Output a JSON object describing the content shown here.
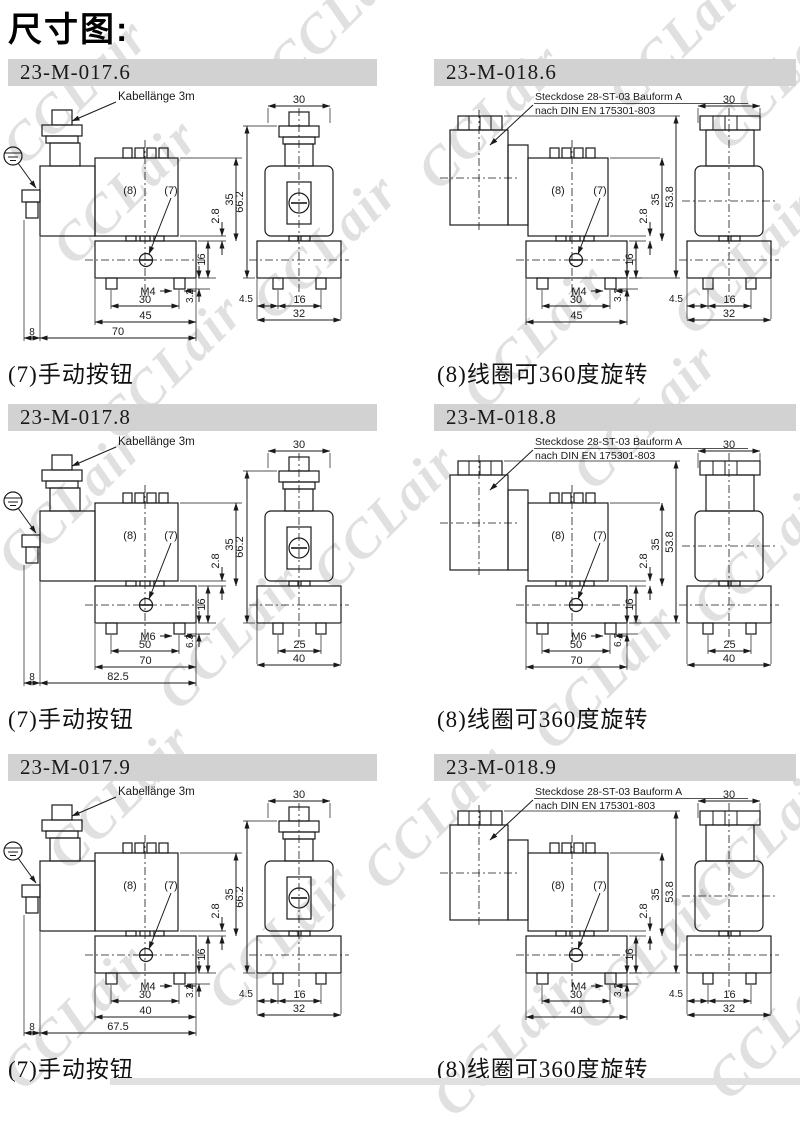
{
  "page": {
    "title": "尺寸图:",
    "watermark_text": "CCLair"
  },
  "colors": {
    "titlebar_bg": "#d2d2d2",
    "line": "#1a1a1a",
    "watermark": "rgba(0,0,0,0.12)"
  },
  "panels": [
    {
      "id": "23-M-017.6",
      "type": "cable",
      "top_label": "Kabellänge 3m",
      "top_label2": "",
      "callout_coil": "(8)",
      "callout_button": "(7)",
      "caption": "(7)手动按钮",
      "dims": {
        "coil_h": "35",
        "gap": "2.8",
        "body_h": "16",
        "thread_depth": "3.2",
        "thread": "M4",
        "hole_spacing": "30",
        "body_w": "45",
        "overall_w": "70",
        "left_offset": "8",
        "overall_h": "66.2",
        "front_w": "30",
        "front_foot_off": "4.5",
        "front_holes": "16",
        "front_w2": "32"
      }
    },
    {
      "id": "23-M-018.6",
      "type": "connector",
      "top_label": "Steckdose 28-ST-03 Bauform A",
      "top_label2": "nach DIN EN 175301-803",
      "callout_coil": "(8)",
      "callout_button": "(7)",
      "caption": "(8)线圈可360度旋转",
      "dims": {
        "coil_h": "35",
        "gap": "2.8",
        "body_h": "16",
        "thread_depth": "3.2",
        "thread": "M4",
        "hole_spacing": "30",
        "body_w": "45",
        "overall_h": "53.8",
        "front_w": "30",
        "front_foot_off": "4.5",
        "front_holes": "16",
        "front_w2": "32"
      }
    },
    {
      "id": "23-M-017.8",
      "type": "cable",
      "top_label": "Kabellänge 3m",
      "top_label2": "",
      "callout_coil": "(8)",
      "callout_button": "(7)",
      "caption": "(7)手动按钮",
      "dims": {
        "coil_h": "35",
        "gap": "2.8",
        "body_h": "16",
        "thread_depth": "6.3",
        "thread": "M6",
        "hole_spacing": "50",
        "body_w": "70",
        "overall_w": "82.5",
        "left_offset": "8",
        "overall_h": "66.2",
        "front_w": "30",
        "front_foot_off": null,
        "front_holes": "25",
        "front_w2": "40"
      }
    },
    {
      "id": "23-M-018.8",
      "type": "connector",
      "top_label": "Steckdose 28-ST-03 Bauform A",
      "top_label2": "nach DIN EN 175301-803",
      "callout_coil": "(8)",
      "callout_button": "(7)",
      "caption": "(8)线圈可360度旋转",
      "dims": {
        "coil_h": "35",
        "gap": "2.8",
        "body_h": "16",
        "thread_depth": "6.3",
        "thread": "M6",
        "hole_spacing": "50",
        "body_w": "70",
        "overall_h": "53.8",
        "front_w": "30",
        "front_foot_off": null,
        "front_holes": "25",
        "front_w2": "40"
      }
    },
    {
      "id": "23-M-017.9",
      "type": "cable",
      "top_label": "Kabellänge 3m",
      "top_label2": "",
      "callout_coil": "(8)",
      "callout_button": "(7)",
      "caption": "(7)手动按钮",
      "dims": {
        "coil_h": "35",
        "gap": "2.8",
        "body_h": "16",
        "thread_depth": "3.2",
        "thread": "M4",
        "hole_spacing": "30",
        "body_w": "40",
        "overall_w": "67.5",
        "left_offset": "8",
        "overall_h": "66.2",
        "front_w": "30",
        "front_foot_off": "4.5",
        "front_holes": "16",
        "front_w2": "32"
      }
    },
    {
      "id": "23-M-018.9",
      "type": "connector",
      "top_label": "Steckdose 28-ST-03 Bauform A",
      "top_label2": "nach DIN EN 175301-803",
      "callout_coil": "(8)",
      "callout_button": "(7)",
      "caption": "(8)线圈可360度旋转",
      "dims": {
        "coil_h": "35",
        "gap": "2.8",
        "body_h": "16",
        "thread_depth": "3.2",
        "thread": "M4",
        "hole_spacing": "30",
        "body_w": "40",
        "overall_h": "53.8",
        "front_w": "30",
        "front_foot_off": "4.5",
        "front_holes": "16",
        "front_w2": "32"
      }
    }
  ]
}
